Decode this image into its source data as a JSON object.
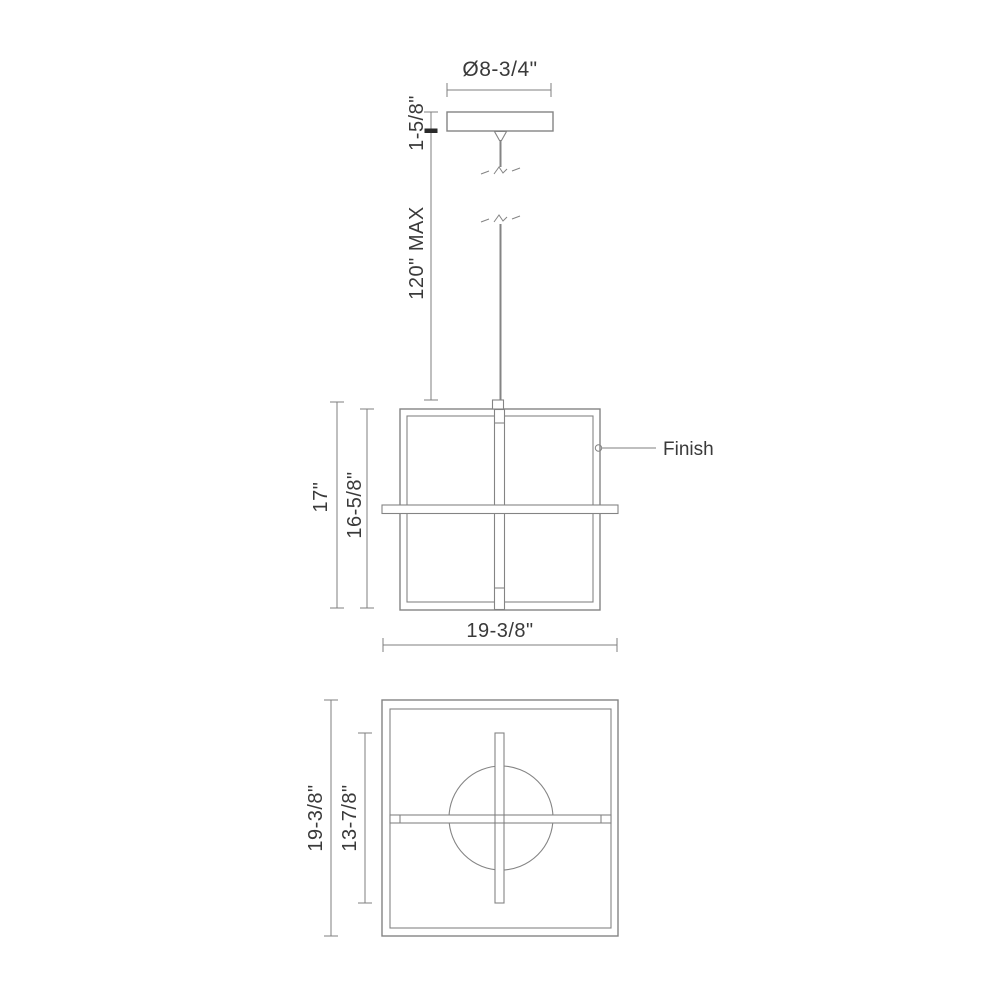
{
  "title": "Pendant fixture dimension drawing",
  "colors": {
    "line": "#848484",
    "dim_line": "#7f7f7f",
    "text": "#3a3a3a",
    "bold_tick": "#2a2a2a",
    "background": "#ffffff"
  },
  "canopy": {
    "diameter_label": "Ø8-3/4\"",
    "height_label": "1-5/8\""
  },
  "suspension": {
    "max_drop_label": "120\" MAX"
  },
  "front_view": {
    "overall_height_label": "17\"",
    "frame_height_label": "16-5/8\"",
    "overall_width_label": "19-3/8\"",
    "finish_label": "Finish"
  },
  "plan_view": {
    "overall_depth_label": "19-3/8\"",
    "inner_depth_label": "13-7/8\""
  }
}
